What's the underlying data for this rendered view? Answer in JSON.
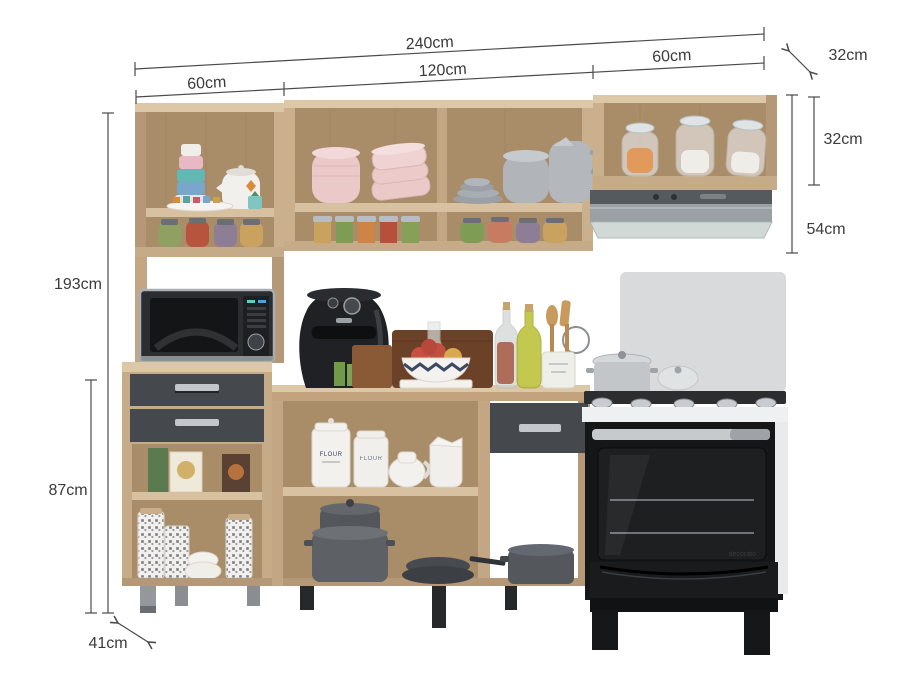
{
  "dimensions": {
    "total_width": "240cm",
    "left_section_width": "60cm",
    "middle_section_width": "120cm",
    "right_section_width": "60cm",
    "upper_cabinet_depth": "32cm",
    "upper_cabinet_height": "32cm",
    "hood_section_height": "54cm",
    "total_height": "193cm",
    "base_height": "87cm",
    "base_depth": "41cm"
  },
  "product_texts": {
    "canister_label": "FLOUR",
    "canister_label_2": "FLOUR",
    "oven_brand": "decorato"
  },
  "colors": {
    "wood_front": "#cbb08d",
    "wood_light": "#dcc7a6",
    "wood_side": "#b49878",
    "wood_interior": "#a98c68",
    "drawer_gray": "#45494e",
    "steel": "#c3c7cb",
    "appliance_black": "#1a1b1d",
    "stove_white": "#eef0f1",
    "backsplash_gray": "#d9dadb",
    "dimension_line": "#4a4a4a",
    "background": "#ffffff"
  }
}
